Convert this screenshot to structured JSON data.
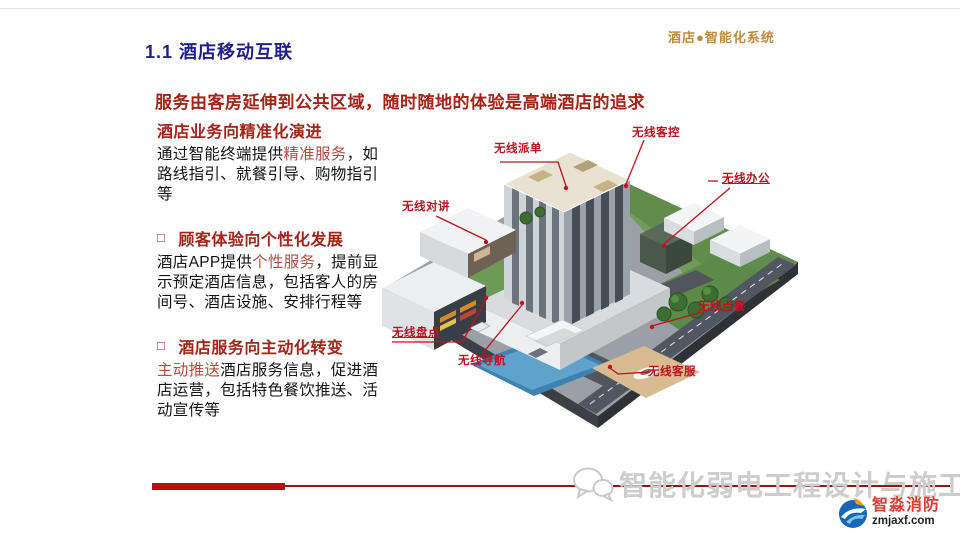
{
  "header": {
    "corner_label": "酒店●智能化系统",
    "title": "1.1 酒店移动互联"
  },
  "subtitle": "服务由客房延伸到公共区域，随时随地的体验是高端酒店的追求",
  "bullets": [
    {
      "heading": "酒店业务向精准化演进",
      "body_pre": "通过智能终端提供",
      "body_highlight": "精准服务",
      "body_post": "，如路线指引、就餐引导、购物指引等"
    },
    {
      "glyph": "□",
      "heading": "顾客体验向个性化发展",
      "body_pre": "酒店APP提供",
      "body_highlight": "个性服务",
      "body_post": "，提前显示预定酒店信息，包括客人的房间号、酒店设施、安排行程等"
    },
    {
      "glyph": "□",
      "heading": "酒店服务向主动化转变",
      "body_pre": "",
      "body_highlight": "主动推送",
      "body_post": "酒店服务信息，促进酒店运营，包括特色餐饮推送、活动宣传等"
    }
  ],
  "diagram": {
    "labels": [
      {
        "text": "无线派单"
      },
      {
        "text": "无线客控"
      },
      {
        "text": "无线办公"
      },
      {
        "text": "无线对讲"
      },
      {
        "text": "无线盘点"
      },
      {
        "text": "无线导航"
      },
      {
        "text": "无线点餐"
      },
      {
        "text": "无线客服"
      }
    ]
  },
  "footer": {
    "watermark": "智能化弱电工程设计与施工",
    "logo_name": "智淼消防",
    "logo_url": "zmjaxf.com"
  },
  "colors": {
    "title_navy": "#1f1f8f",
    "heading_red": "#a62318",
    "highlight_red": "#bb4a3f",
    "corner_orange": "#bf8a3a",
    "label_red": "#c1121f",
    "bar_red": "#b01111",
    "watermark_gray": "#cdcdcd",
    "logo_blue": "#1565b8",
    "logo_orange": "#f59a1e",
    "logo_red": "#e23b30"
  }
}
